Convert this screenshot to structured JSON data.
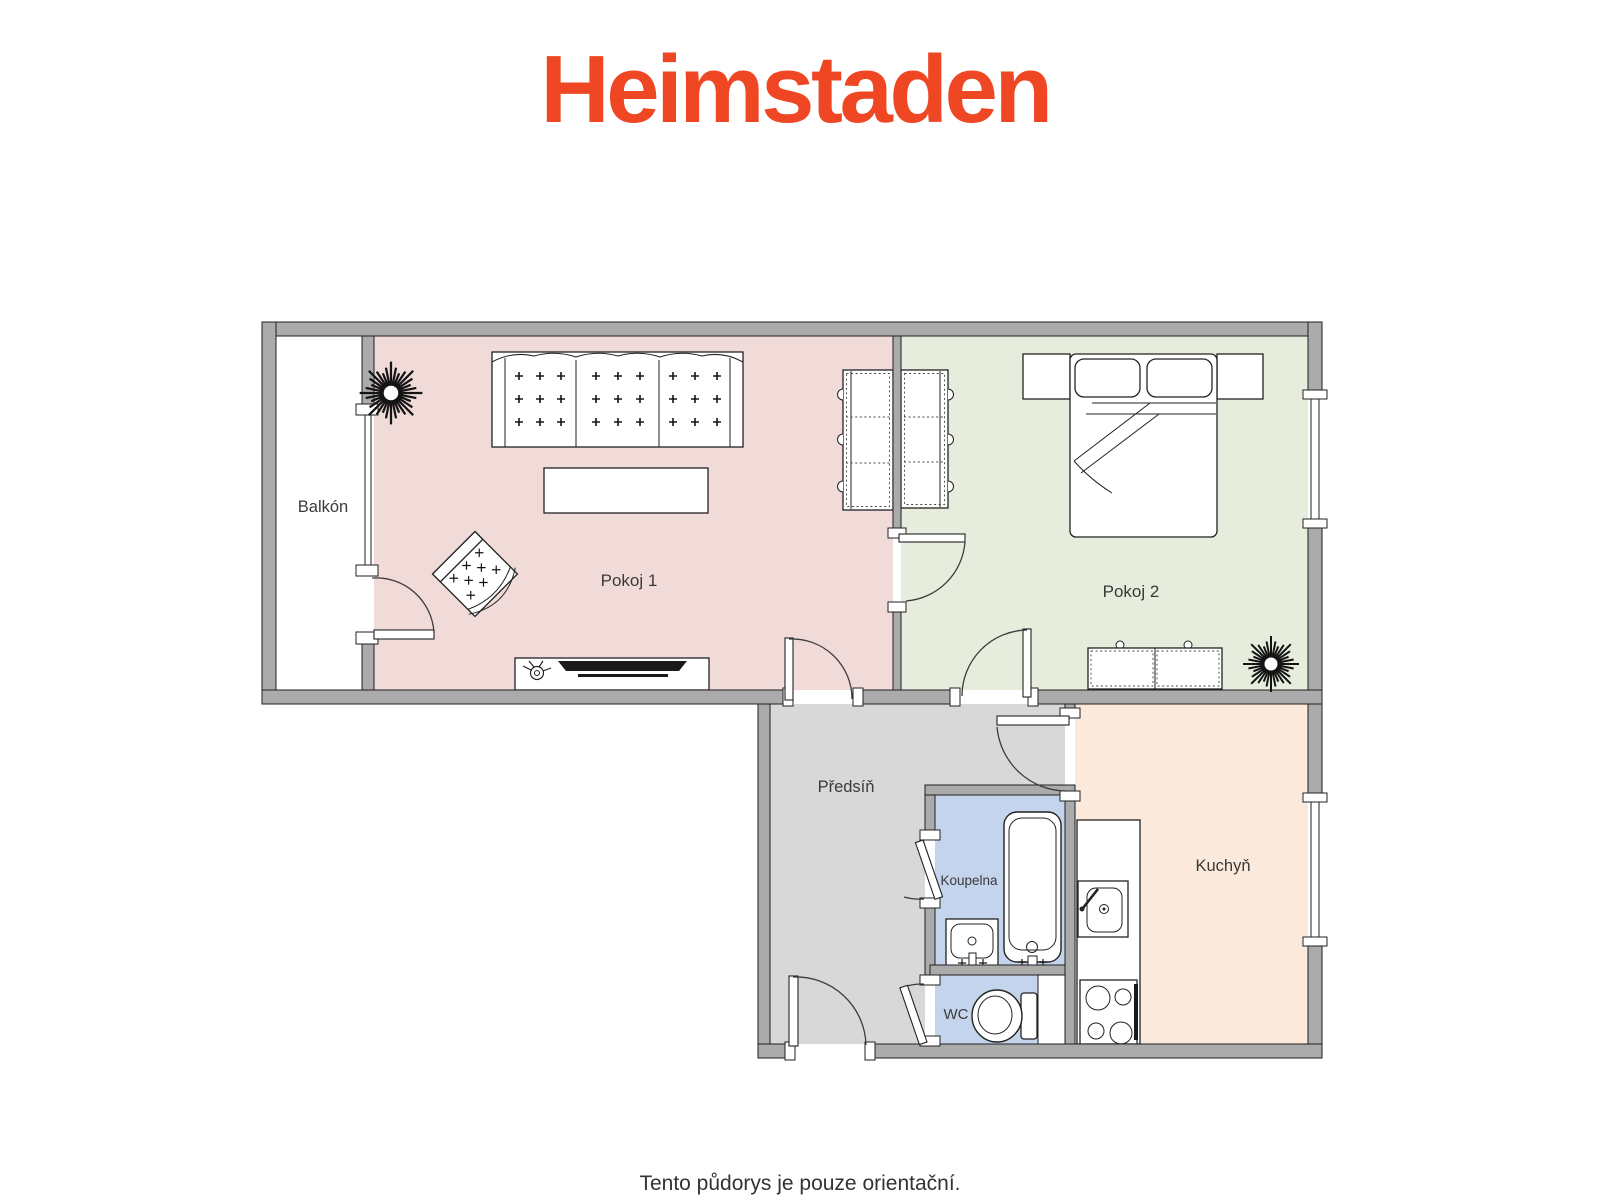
{
  "logo": {
    "text": "Heimstaden",
    "color": "#EF4723"
  },
  "rooms": {
    "balkon": {
      "label": "Balkón",
      "fill": "#FFFFFF"
    },
    "pokoj1": {
      "label": "Pokoj 1",
      "fill": "#F1DBD8"
    },
    "pokoj2": {
      "label": "Pokoj 2",
      "fill": "#E7EDDC"
    },
    "predsin": {
      "label": "Předsíň",
      "fill": "#D8D8D8"
    },
    "koupelna": {
      "label": "Koupelna",
      "fill": "#C4D4ED"
    },
    "wc": {
      "label": "WC",
      "fill": "#C4D4ED"
    },
    "kuchyn": {
      "label": "Kuchyň",
      "fill": "#FBE9DB"
    }
  },
  "footer": {
    "note": "Tento půdorys je pouze orientační."
  },
  "colors": {
    "wall": "#ABABAB",
    "outline": "#1F1F1F",
    "door_arc": "#3C3C3C",
    "label": "#3A3A3A"
  },
  "icons": {
    "plant": "starburst-plant",
    "bathtub": "bathtub-top-view",
    "toilet": "toilet-top-view",
    "stove": "four-burner-stove",
    "sink": "kitchen-sink"
  }
}
